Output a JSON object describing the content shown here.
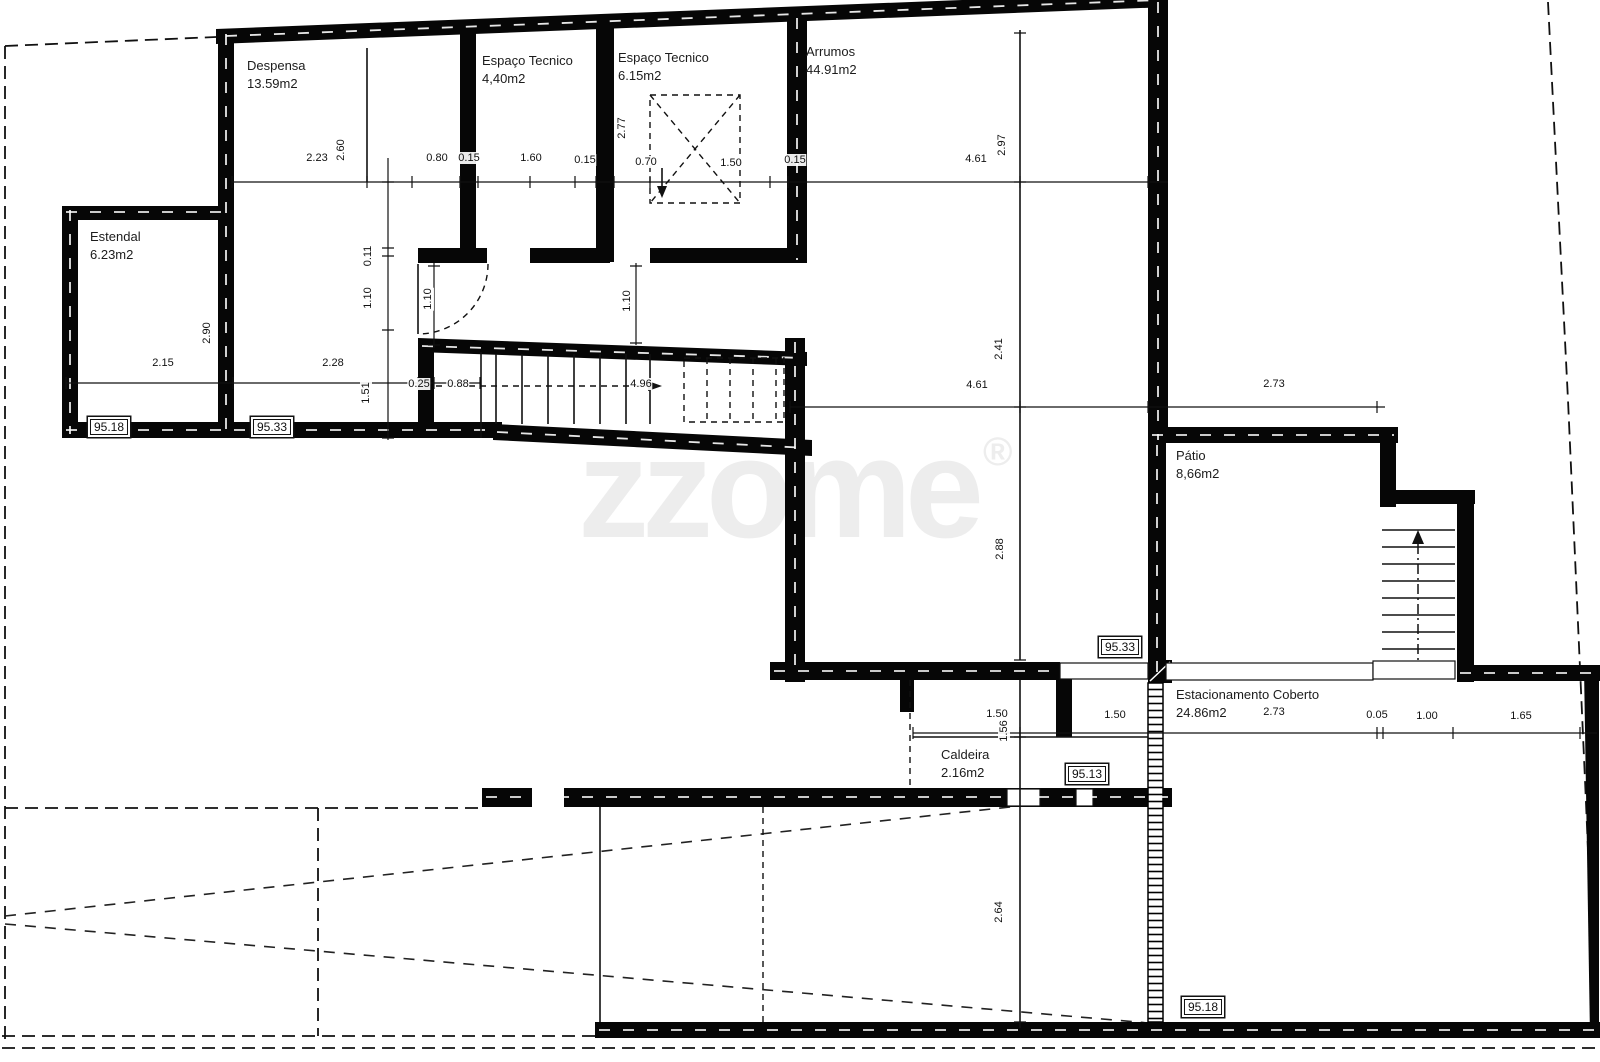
{
  "document": {
    "kind": "architectural floor plan"
  },
  "watermark": {
    "text": "zzome",
    "registered": "®"
  },
  "rooms": [
    {
      "name": "Despensa",
      "area": "13.59m2"
    },
    {
      "name": "Espaço Tecnico",
      "area": "4,40m2"
    },
    {
      "name": "Espaço Tecnico",
      "area": "6.15m2"
    },
    {
      "name": "Arrumos",
      "area": "44.91m2"
    },
    {
      "name": "Estendal",
      "area": "6.23m2"
    },
    {
      "name": "Pátio",
      "area": "8,66m2"
    },
    {
      "name": "Estacionamento Coberto",
      "area": "24.86m2"
    },
    {
      "name": "Caldeira",
      "area": "2.16m2"
    }
  ],
  "levels": [
    "95.18",
    "95.33",
    "95.33",
    "95.13",
    "95.18"
  ],
  "dims": {
    "h": [
      "2.23",
      "0.80",
      "0.15",
      "1.60",
      "0.15",
      "0.70",
      "1.50",
      "0.15",
      "4.61",
      "2.15",
      "2.28",
      "0.25",
      "0.88",
      "4.96",
      "4.61",
      "2.73",
      "1.50",
      "1.50",
      "2.73",
      "0.05",
      "1.00",
      "1.65"
    ],
    "v": [
      "2.60",
      "2.77",
      "2.97",
      "0.11",
      "1.10",
      "1.10",
      "1.10",
      "2.90",
      "1.51",
      "2.41",
      "2.88",
      "1.56",
      "2.64"
    ]
  },
  "colors": {
    "wall": "#060606",
    "line": "#111111",
    "watermark": "#ededed",
    "paper": "#ffffff"
  }
}
